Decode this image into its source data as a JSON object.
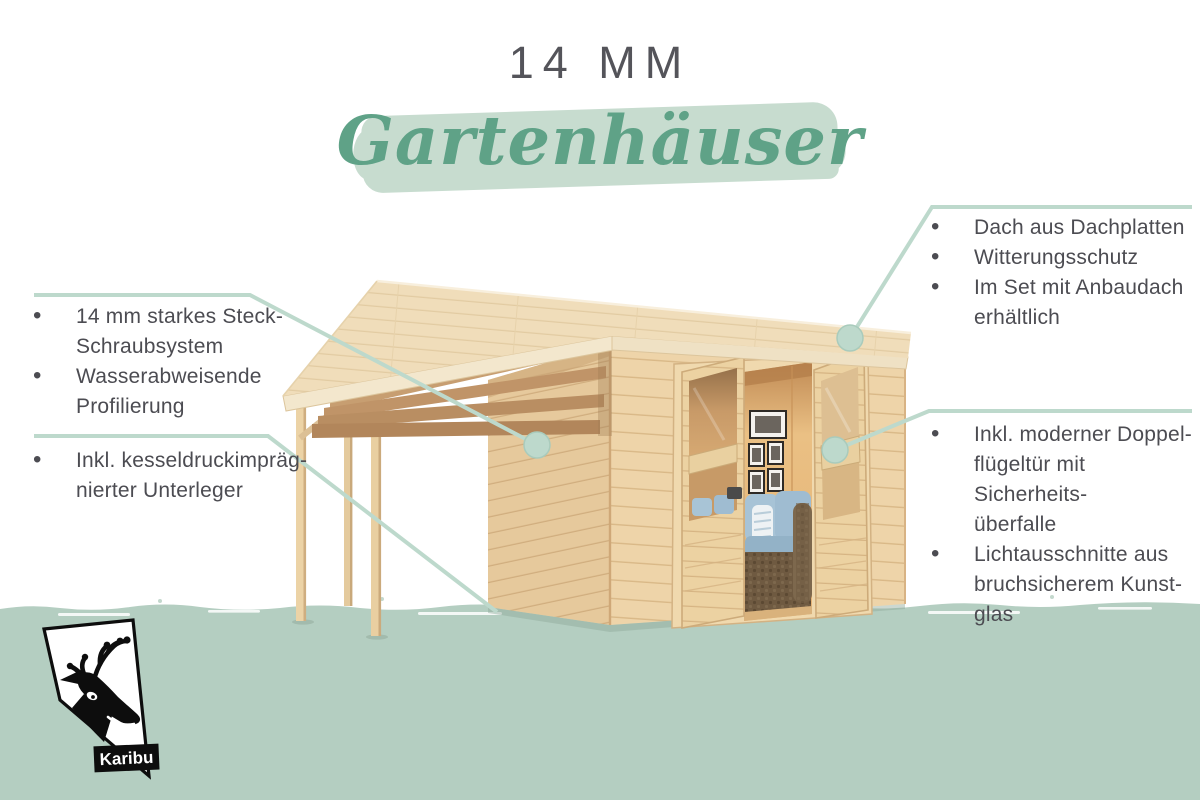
{
  "header": {
    "size_label": "14 MM",
    "title": "Gartenhäuser"
  },
  "callouts": {
    "left_top": {
      "items": [
        "14 mm starkes Steck-\nSchraubsystem",
        "Wasserabweisende\nProfilierung"
      ]
    },
    "left_bottom": {
      "items": [
        "Inkl. kesseldruckimpräg-\nnierter Unterleger"
      ]
    },
    "right_top": {
      "items": [
        "Dach aus Dachplatten",
        "Witterungsschutz",
        "Im Set mit Anbaudach\nerhältlich"
      ]
    },
    "right_bottom": {
      "items": [
        "Inkl. moderner Doppel-\nflügeltür mit Sicherheits-\nüberfalle",
        "Lichtausschnitte aus\nbruchsicherem Kunst-\nglas"
      ]
    }
  },
  "logo": {
    "brand": "Karibu"
  },
  "colors": {
    "accent_green": "#5fa287",
    "highlight_band": "#c7dccf",
    "ground_band": "#b4cec1",
    "callout_line": "#bdd9cc",
    "text_dark": "#4c4c52",
    "title_gray": "#54545a"
  }
}
